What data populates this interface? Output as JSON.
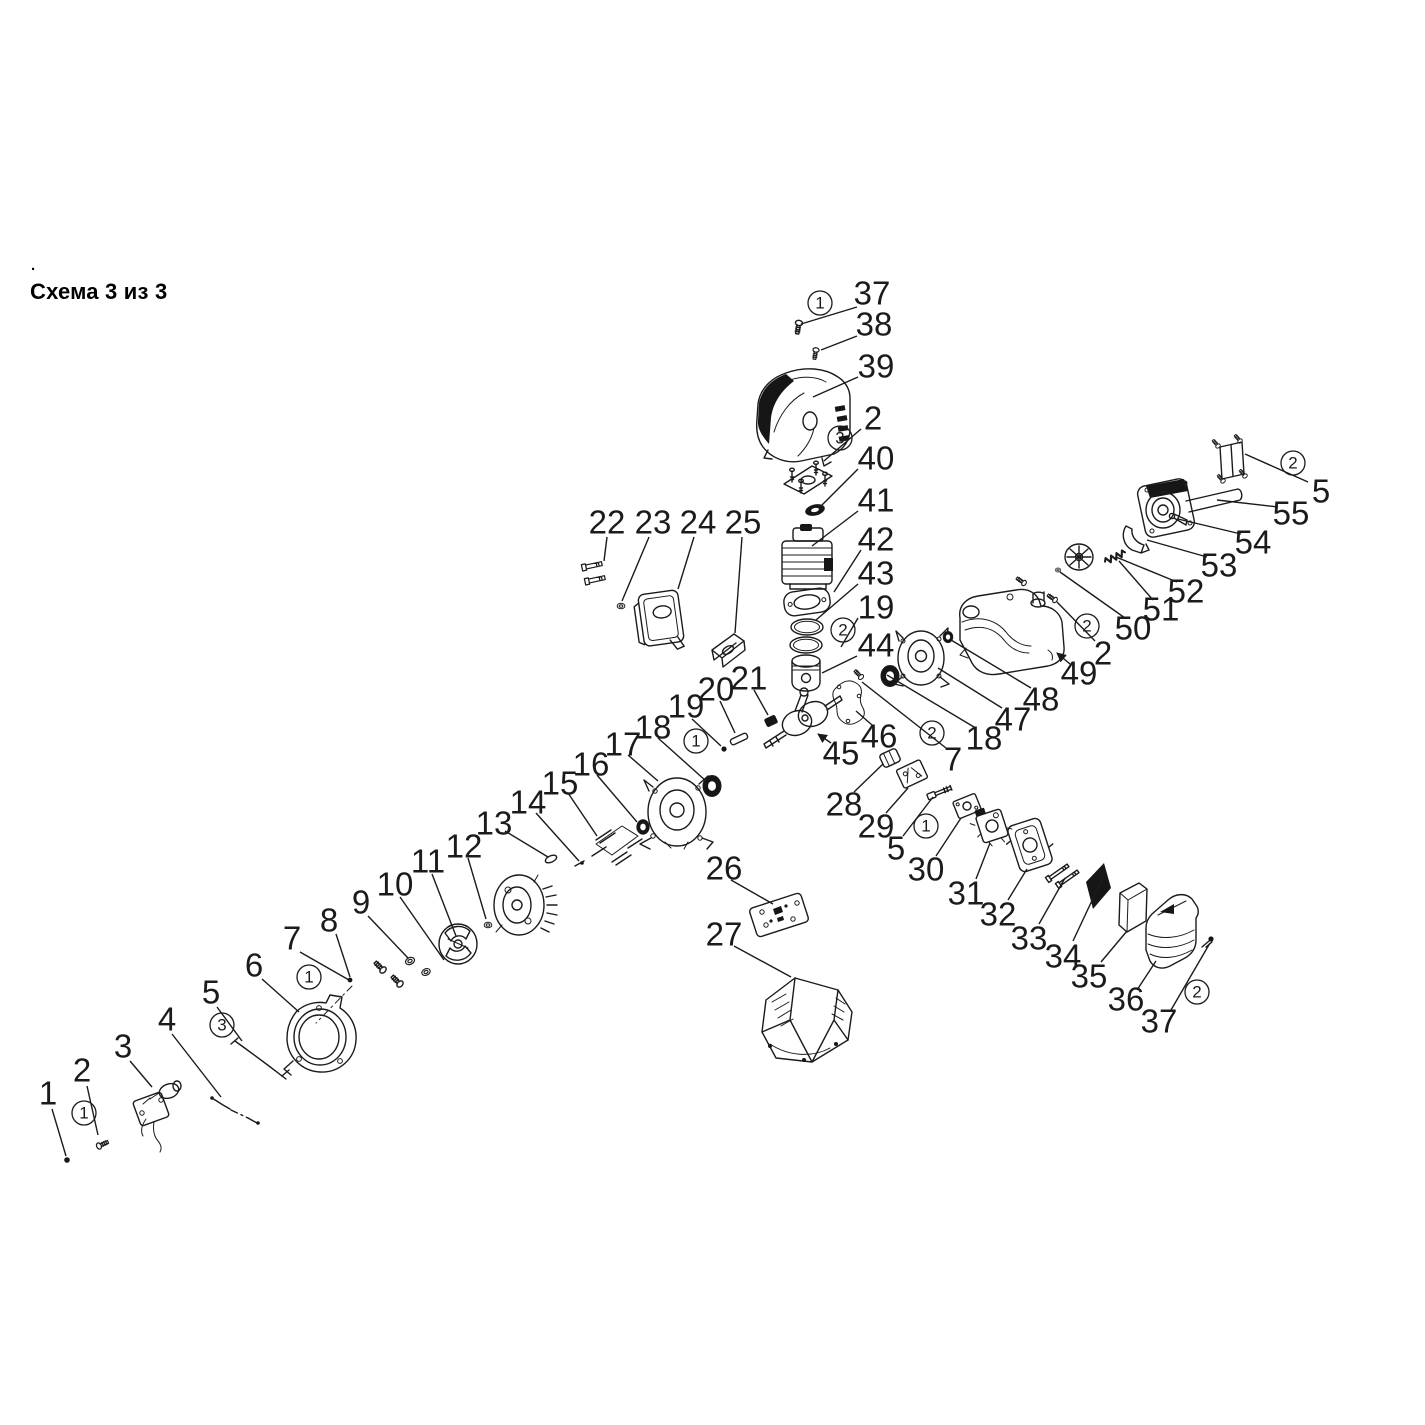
{
  "page": {
    "title": "Схема 3 из 3",
    "leading_dot": ".",
    "background_color": "#ffffff",
    "ink_color": "#1b1b1b"
  },
  "diagram": {
    "type": "exploded-parts-diagram",
    "label_font_px": 33,
    "callout_radius": 12,
    "part_labels": [
      {
        "text": "37",
        "x": 872,
        "y": 293,
        "leader": [
          857,
          307,
          801,
          324
        ]
      },
      {
        "text": "38",
        "x": 874,
        "y": 324,
        "leader": [
          857,
          336,
          821,
          350
        ]
      },
      {
        "text": "39",
        "x": 876,
        "y": 366,
        "leader": [
          858,
          377,
          813,
          397
        ]
      },
      {
        "text": "2",
        "x": 873,
        "y": 418,
        "leader": [
          861,
          429,
          824,
          461
        ]
      },
      {
        "text": "40",
        "x": 876,
        "y": 458,
        "leader": [
          858,
          469,
          820,
          507
        ]
      },
      {
        "text": "41",
        "x": 876,
        "y": 500,
        "leader": [
          858,
          511,
          812,
          546
        ]
      },
      {
        "text": "42",
        "x": 876,
        "y": 539,
        "leader": [
          861,
          550,
          834,
          592
        ]
      },
      {
        "text": "43",
        "x": 876,
        "y": 573,
        "leader": [
          858,
          584,
          816,
          620
        ]
      },
      {
        "text": "19",
        "x": 876,
        "y": 607,
        "leader": [
          858,
          618,
          841,
          647
        ]
      },
      {
        "text": "44",
        "x": 876,
        "y": 645,
        "leader": [
          857,
          656,
          822,
          673
        ]
      },
      {
        "text": "1",
        "x": 48,
        "y": 1093,
        "leader": [
          52,
          1109,
          66,
          1156
        ]
      },
      {
        "text": "2",
        "x": 82,
        "y": 1070,
        "leader": [
          87,
          1086,
          98,
          1135
        ]
      },
      {
        "text": "3",
        "x": 123,
        "y": 1046,
        "leader": [
          130,
          1061,
          152,
          1087
        ]
      },
      {
        "text": "4",
        "x": 167,
        "y": 1019,
        "leader": [
          172,
          1034,
          221,
          1097
        ]
      },
      {
        "text": "5",
        "x": 211,
        "y": 992,
        "leader": [
          217,
          1007,
          242,
          1041
        ]
      },
      {
        "text": "6",
        "x": 254,
        "y": 965,
        "leader": [
          262,
          979,
          299,
          1012
        ]
      },
      {
        "text": "7",
        "x": 292,
        "y": 938,
        "leader": [
          300,
          952,
          349,
          980
        ]
      },
      {
        "text": "8",
        "x": 329,
        "y": 920,
        "leader": [
          336,
          934,
          350,
          977
        ]
      },
      {
        "text": "9",
        "x": 361,
        "y": 902,
        "leader": [
          368,
          916,
          408,
          958
        ]
      },
      {
        "text": "10",
        "x": 395,
        "y": 884,
        "leader": [
          400,
          897,
          444,
          960
        ]
      },
      {
        "text": "11",
        "x": 428,
        "y": 861,
        "leader": [
          432,
          874,
          456,
          936
        ]
      },
      {
        "text": "12",
        "x": 464,
        "y": 846,
        "leader": [
          468,
          858,
          486,
          919
        ]
      },
      {
        "text": "13",
        "x": 494,
        "y": 823,
        "leader": [
          505,
          831,
          548,
          857
        ]
      },
      {
        "text": "14",
        "x": 528,
        "y": 802,
        "leader": [
          536,
          813,
          579,
          861
        ]
      },
      {
        "text": "15",
        "x": 560,
        "y": 783,
        "leader": [
          568,
          793,
          597,
          836
        ]
      },
      {
        "text": "16",
        "x": 591,
        "y": 764,
        "leader": [
          597,
          775,
          637,
          822
        ]
      },
      {
        "text": "17",
        "x": 623,
        "y": 744,
        "leader": [
          628,
          755,
          658,
          781
        ]
      },
      {
        "text": "18",
        "x": 653,
        "y": 727,
        "leader": [
          658,
          738,
          706,
          781
        ]
      },
      {
        "text": "22",
        "x": 607,
        "y": 522,
        "leader": [
          607,
          537,
          604,
          561
        ]
      },
      {
        "text": "23",
        "x": 653,
        "y": 522,
        "leader": [
          649,
          537,
          622,
          601
        ]
      },
      {
        "text": "24",
        "x": 698,
        "y": 522,
        "leader": [
          694,
          537,
          678,
          589
        ]
      },
      {
        "text": "25",
        "x": 743,
        "y": 522,
        "leader": [
          742,
          537,
          735,
          633
        ]
      },
      {
        "text": "19",
        "x": 686,
        "y": 706,
        "leader": [
          692,
          719,
          721,
          746
        ]
      },
      {
        "text": "20",
        "x": 716,
        "y": 689,
        "leader": [
          720,
          701,
          735,
          733
        ]
      },
      {
        "text": "21",
        "x": 749,
        "y": 678,
        "leader": [
          754,
          690,
          768,
          715
        ]
      },
      {
        "text": "26",
        "x": 724,
        "y": 868,
        "leader": [
          731,
          880,
          773,
          904
        ]
      },
      {
        "text": "27",
        "x": 724,
        "y": 934,
        "leader": [
          734,
          946,
          791,
          977
        ]
      },
      {
        "text": "45",
        "x": 841,
        "y": 753,
        "leader": [
          831,
          743,
          818,
          734
        ],
        "arrow": true
      },
      {
        "text": "46",
        "x": 879,
        "y": 736,
        "leader": [
          872,
          725,
          856,
          711
        ]
      },
      {
        "text": "7",
        "x": 953,
        "y": 759,
        "leader": [
          946,
          748,
          862,
          682
        ]
      },
      {
        "text": "18",
        "x": 984,
        "y": 738,
        "leader": [
          974,
          727,
          887,
          675
        ]
      },
      {
        "text": "47",
        "x": 1013,
        "y": 719,
        "leader": [
          1002,
          708,
          938,
          668
        ]
      },
      {
        "text": "48",
        "x": 1041,
        "y": 699,
        "leader": [
          1031,
          688,
          951,
          640
        ]
      },
      {
        "text": "49",
        "x": 1079,
        "y": 673,
        "leader": [
          1070,
          664,
          1057,
          653
        ],
        "arrow": true
      },
      {
        "text": "2",
        "x": 1103,
        "y": 653,
        "leader": [
          1095,
          641,
          1057,
          602
        ]
      },
      {
        "text": "50",
        "x": 1133,
        "y": 628,
        "leader": [
          1125,
          618,
          1060,
          572
        ]
      },
      {
        "text": "51",
        "x": 1161,
        "y": 609,
        "leader": [
          1153,
          600,
          1119,
          561
        ]
      },
      {
        "text": "52",
        "x": 1186,
        "y": 591,
        "leader": [
          1177,
          582,
          1116,
          557
        ]
      },
      {
        "text": "53",
        "x": 1219,
        "y": 565,
        "leader": [
          1207,
          557,
          1147,
          540
        ]
      },
      {
        "text": "54",
        "x": 1253,
        "y": 542,
        "leader": [
          1241,
          534,
          1178,
          519
        ]
      },
      {
        "text": "55",
        "x": 1291,
        "y": 513,
        "leader": [
          1278,
          507,
          1217,
          500
        ]
      },
      {
        "text": "5",
        "x": 1321,
        "y": 491,
        "leader": [
          1308,
          482,
          1245,
          454
        ]
      },
      {
        "text": "28",
        "x": 844,
        "y": 804,
        "leader": [
          854,
          792,
          883,
          764
        ]
      },
      {
        "text": "29",
        "x": 876,
        "y": 826,
        "leader": [
          886,
          813,
          908,
          788
        ]
      },
      {
        "text": "5",
        "x": 896,
        "y": 848,
        "leader": [
          903,
          836,
          933,
          797
        ]
      },
      {
        "text": "30",
        "x": 926,
        "y": 869,
        "leader": [
          936,
          856,
          961,
          818
        ]
      },
      {
        "text": "31",
        "x": 966,
        "y": 893,
        "leader": [
          976,
          879,
          990,
          843
        ]
      },
      {
        "text": "32",
        "x": 998,
        "y": 914,
        "leader": [
          1008,
          900,
          1027,
          869
        ]
      },
      {
        "text": "33",
        "x": 1029,
        "y": 938,
        "leader": [
          1039,
          924,
          1065,
          878
        ]
      },
      {
        "text": "34",
        "x": 1063,
        "y": 956,
        "leader": [
          1073,
          941,
          1104,
          875
        ]
      },
      {
        "text": "35",
        "x": 1089,
        "y": 976,
        "leader": [
          1101,
          962,
          1127,
          931
        ]
      },
      {
        "text": "36",
        "x": 1126,
        "y": 999,
        "leader": [
          1137,
          990,
          1156,
          961
        ]
      },
      {
        "text": "37",
        "x": 1159,
        "y": 1021,
        "leader": [
          1171,
          1010,
          1210,
          943
        ]
      }
    ],
    "callouts": [
      {
        "text": "1",
        "x": 820,
        "y": 303
      },
      {
        "text": "3",
        "x": 840,
        "y": 438
      },
      {
        "text": "2",
        "x": 843,
        "y": 630
      },
      {
        "text": "1",
        "x": 84,
        "y": 1113
      },
      {
        "text": "3",
        "x": 222,
        "y": 1025
      },
      {
        "text": "1",
        "x": 309,
        "y": 977
      },
      {
        "text": "1",
        "x": 696,
        "y": 741
      },
      {
        "text": "2",
        "x": 932,
        "y": 733
      },
      {
        "text": "2",
        "x": 1087,
        "y": 626
      },
      {
        "text": "2",
        "x": 1293,
        "y": 463
      },
      {
        "text": "1",
        "x": 926,
        "y": 826
      },
      {
        "text": "2",
        "x": 1197,
        "y": 992
      }
    ]
  }
}
